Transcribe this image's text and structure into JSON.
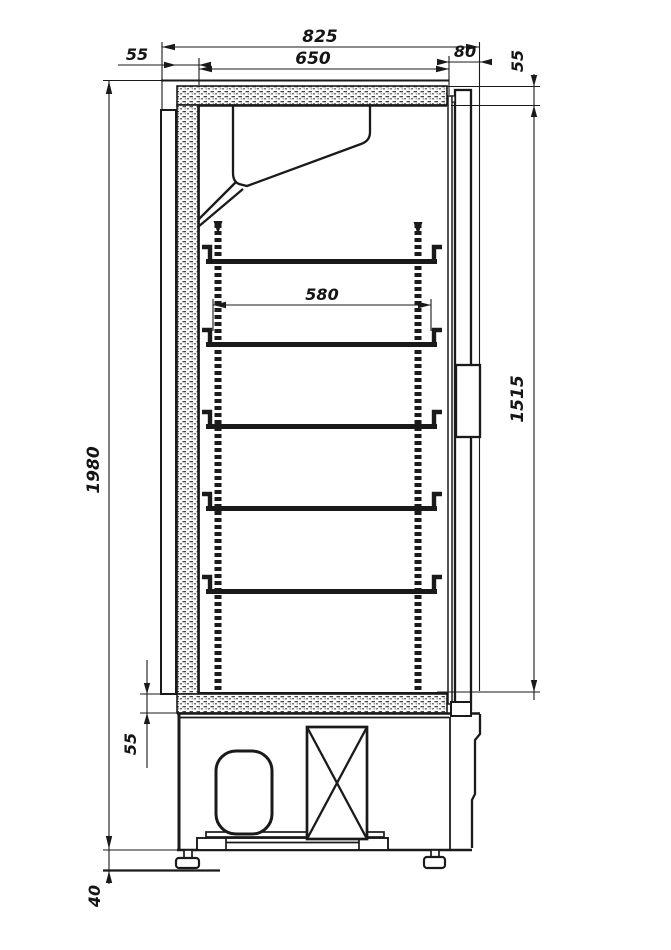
{
  "drawing": {
    "title": "Cabinet cross-section technical drawing",
    "units": "mm",
    "background_color": "#ffffff",
    "line_color": "#1a1a1a",
    "shelf_count": 5,
    "dimensions": {
      "overall_depth": "825",
      "inner_depth": "650",
      "back_wall_thickness": "55",
      "door_thickness": "80",
      "top_panel_thickness": "55",
      "overall_height": "1980",
      "inner_height": "1515",
      "shelf_depth": "580",
      "bottom_panel_thickness": "55",
      "foot_height": "40"
    }
  }
}
